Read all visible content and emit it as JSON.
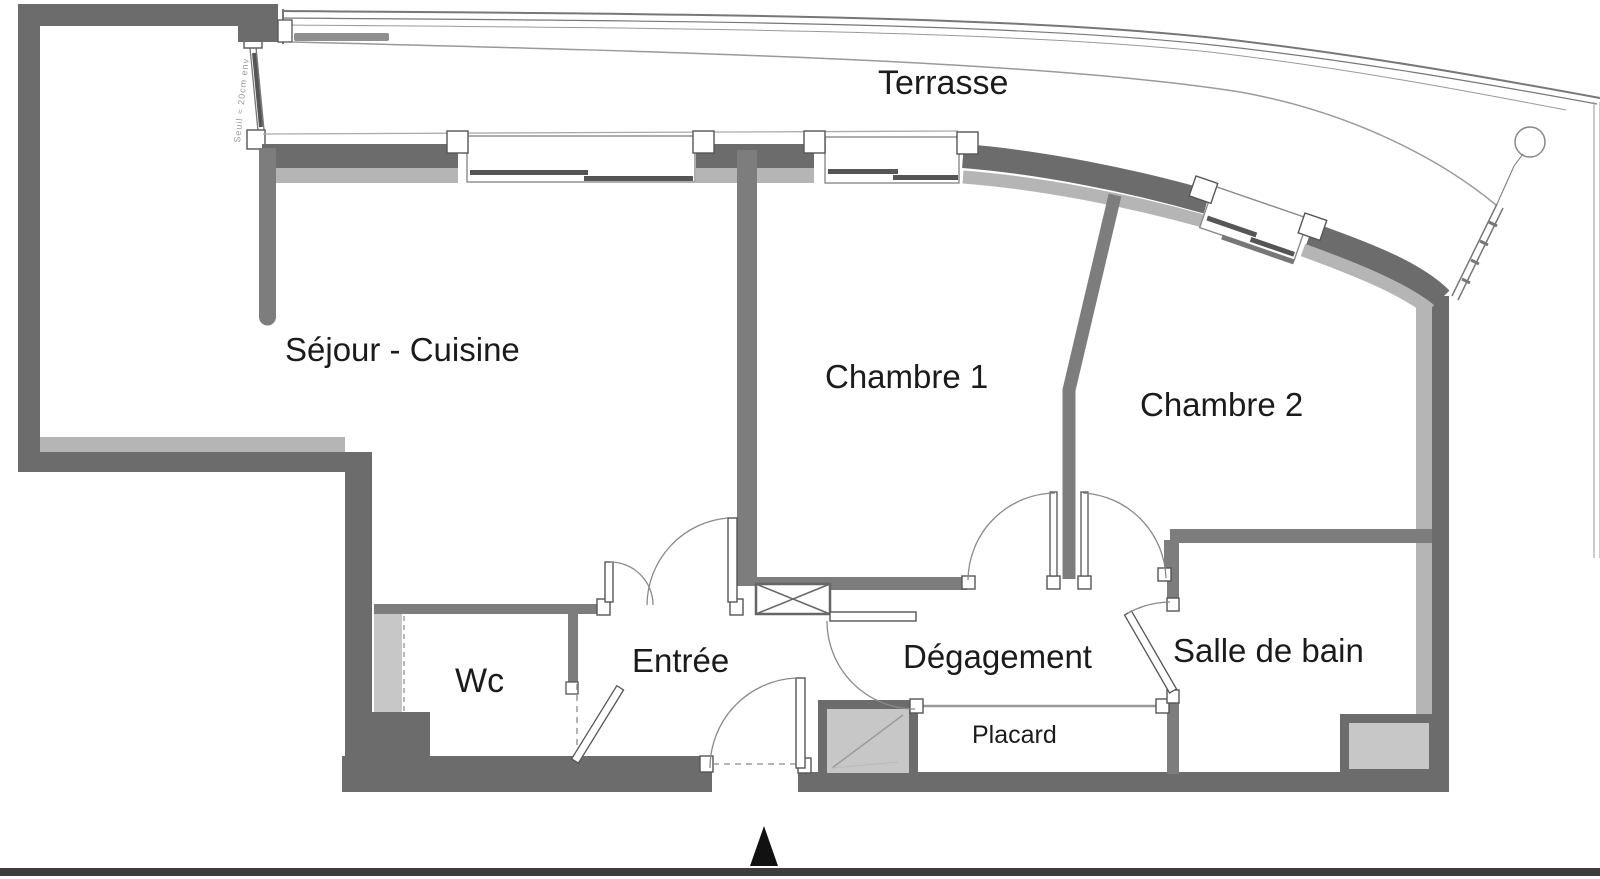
{
  "plan": {
    "type": "apartment-floor-plan",
    "rooms": {
      "terrasse": {
        "label": "Terrasse"
      },
      "sejour_cuisine": {
        "label": "Séjour - Cuisine"
      },
      "chambre1": {
        "label": "Chambre 1"
      },
      "chambre2": {
        "label": "Chambre 2"
      },
      "wc": {
        "label": "Wc"
      },
      "entree": {
        "label": "Entrée"
      },
      "degagement": {
        "label": "Dégagement"
      },
      "salle_de_bain": {
        "label": "Salle de bain"
      },
      "placard": {
        "label": "Placard"
      }
    },
    "annotations": {
      "threshold_note": "Seuil ≈ 20cm env"
    },
    "colors": {
      "wall_dark": "#6c6c6c",
      "wall_interior": "#7d7d7d",
      "wall_light_band": "#b5b5b5",
      "shaft_fill": "#c7c7c7",
      "door_line": "#8a8a8a",
      "text": "#1b1b1b",
      "page_edge": "#3d3d3d"
    }
  }
}
